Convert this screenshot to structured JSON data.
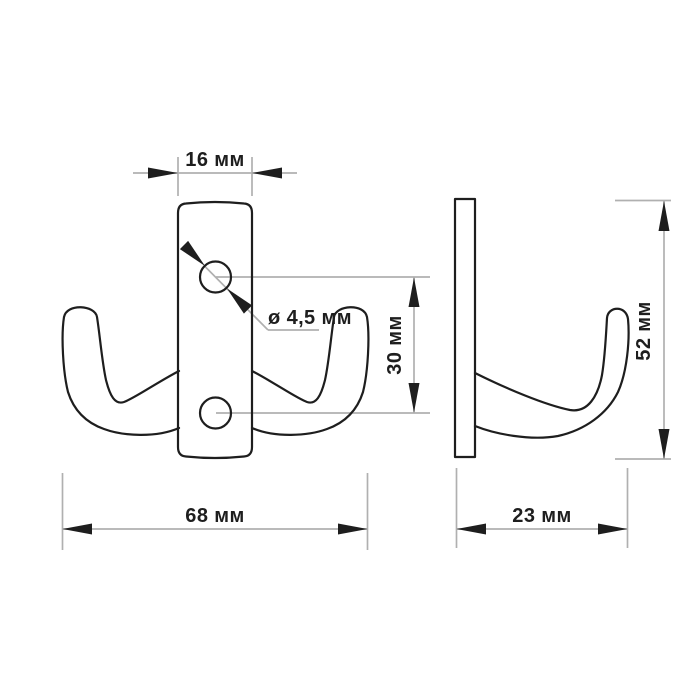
{
  "drawing": {
    "type": "technical-dimension-drawing",
    "subject": "double-prong wall hook, front and side views",
    "dimensions": {
      "plate_width": "16 мм",
      "hole_diameter": "ø 4,5 мм",
      "hole_spacing": "30 мм",
      "total_width": "68 мм",
      "height": "52 мм",
      "depth": "23 мм"
    },
    "colors": {
      "outline": "#1e1e1e",
      "dimension_line": "#b0b0b0",
      "text": "#1e1e1e",
      "background": "#ffffff"
    }
  }
}
